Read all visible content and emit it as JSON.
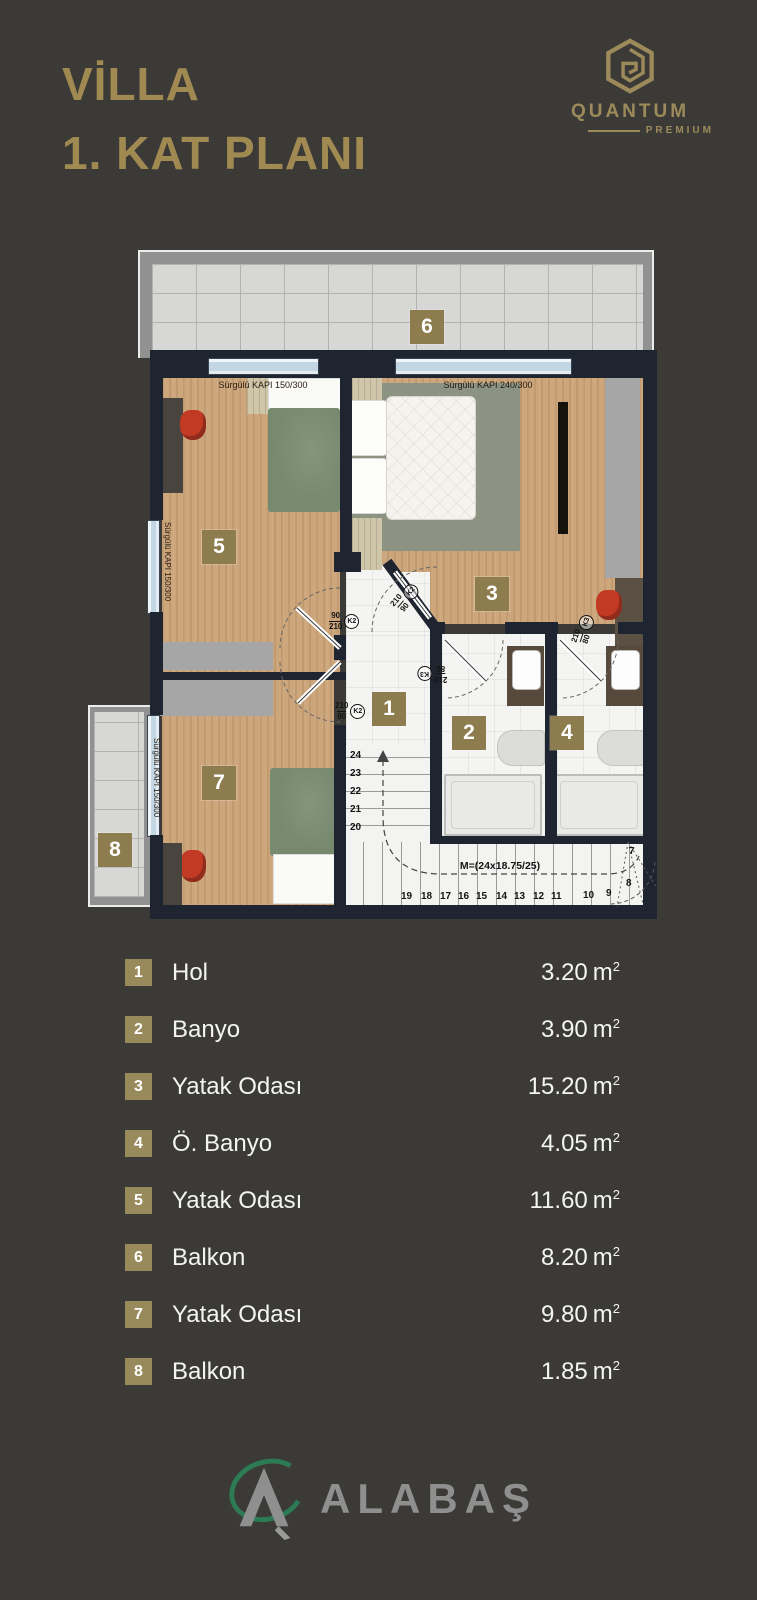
{
  "header": {
    "title_line1": "VİLLA",
    "title_line2": "1. KAT PLANI",
    "brand": {
      "name": "QUANTUM",
      "sub": "PREMIUM"
    }
  },
  "plan": {
    "door_labels": {
      "top_left": "Sürgülü KAPI 150/300",
      "top_right": "Sürgülü KAPI 240/300",
      "left_room5": "Sürgülü KAPI 150/300",
      "balcony8": "Sürgülü KAPI 150/300"
    },
    "door_tags": {
      "room5": {
        "num": "90",
        "den": "210",
        "code": "K2"
      },
      "room3": {
        "num": "210",
        "den": "90",
        "code": "K2"
      },
      "bath2": {
        "num": "210",
        "den": "80",
        "code": "K3"
      },
      "bath4": {
        "num": "210",
        "den": "80",
        "code": "K3"
      },
      "room7": {
        "num": "210",
        "den": "90",
        "code": "K2"
      }
    },
    "badges": {
      "hall": "1",
      "bath": "2",
      "bedroom3": "3",
      "master_bath": "4",
      "bedroom5": "5",
      "balcony6": "6",
      "bedroom7": "7",
      "balcony8": "8"
    },
    "stairs": {
      "formula": "M=(24x18.75/25)",
      "vertical": [
        "24",
        "23",
        "22",
        "21",
        "20"
      ],
      "horizontal": [
        "19",
        "18",
        "17",
        "16",
        "15",
        "14",
        "13",
        "12",
        "11"
      ],
      "fan": [
        "10",
        "9",
        "8",
        "7"
      ]
    }
  },
  "legend": {
    "unit": "m",
    "unit_sup": "2",
    "items": [
      {
        "num": "1",
        "name": "Hol",
        "area": "3.20"
      },
      {
        "num": "2",
        "name": "Banyo",
        "area": "3.90"
      },
      {
        "num": "3",
        "name": "Yatak Odası",
        "area": "15.20"
      },
      {
        "num": "4",
        "name": "Ö. Banyo",
        "area": "4.05"
      },
      {
        "num": "5",
        "name": "Yatak Odası",
        "area": "11.60"
      },
      {
        "num": "6",
        "name": "Balkon",
        "area": "8.20"
      },
      {
        "num": "7",
        "name": "Yatak Odası",
        "area": "9.80"
      },
      {
        "num": "8",
        "name": "Balkon",
        "area": "1.85"
      }
    ]
  },
  "footer": {
    "brand": "ALABAŞ"
  },
  "icons": {
    "brand_mark": "hexagon-spiral",
    "footer_mark": "triangle-swoosh"
  },
  "colors": {
    "background": "#3b3a37",
    "gold": "#a18a52",
    "badge": "#8d7c4e",
    "wall": "#1e2530",
    "wood": "#cda67c",
    "red_chair": "#c23a24",
    "duvet_green": "#77896f",
    "glass": "#c3d6e3",
    "logo_green": "#2c7b55",
    "logo_gray": "#8f8f8f"
  }
}
